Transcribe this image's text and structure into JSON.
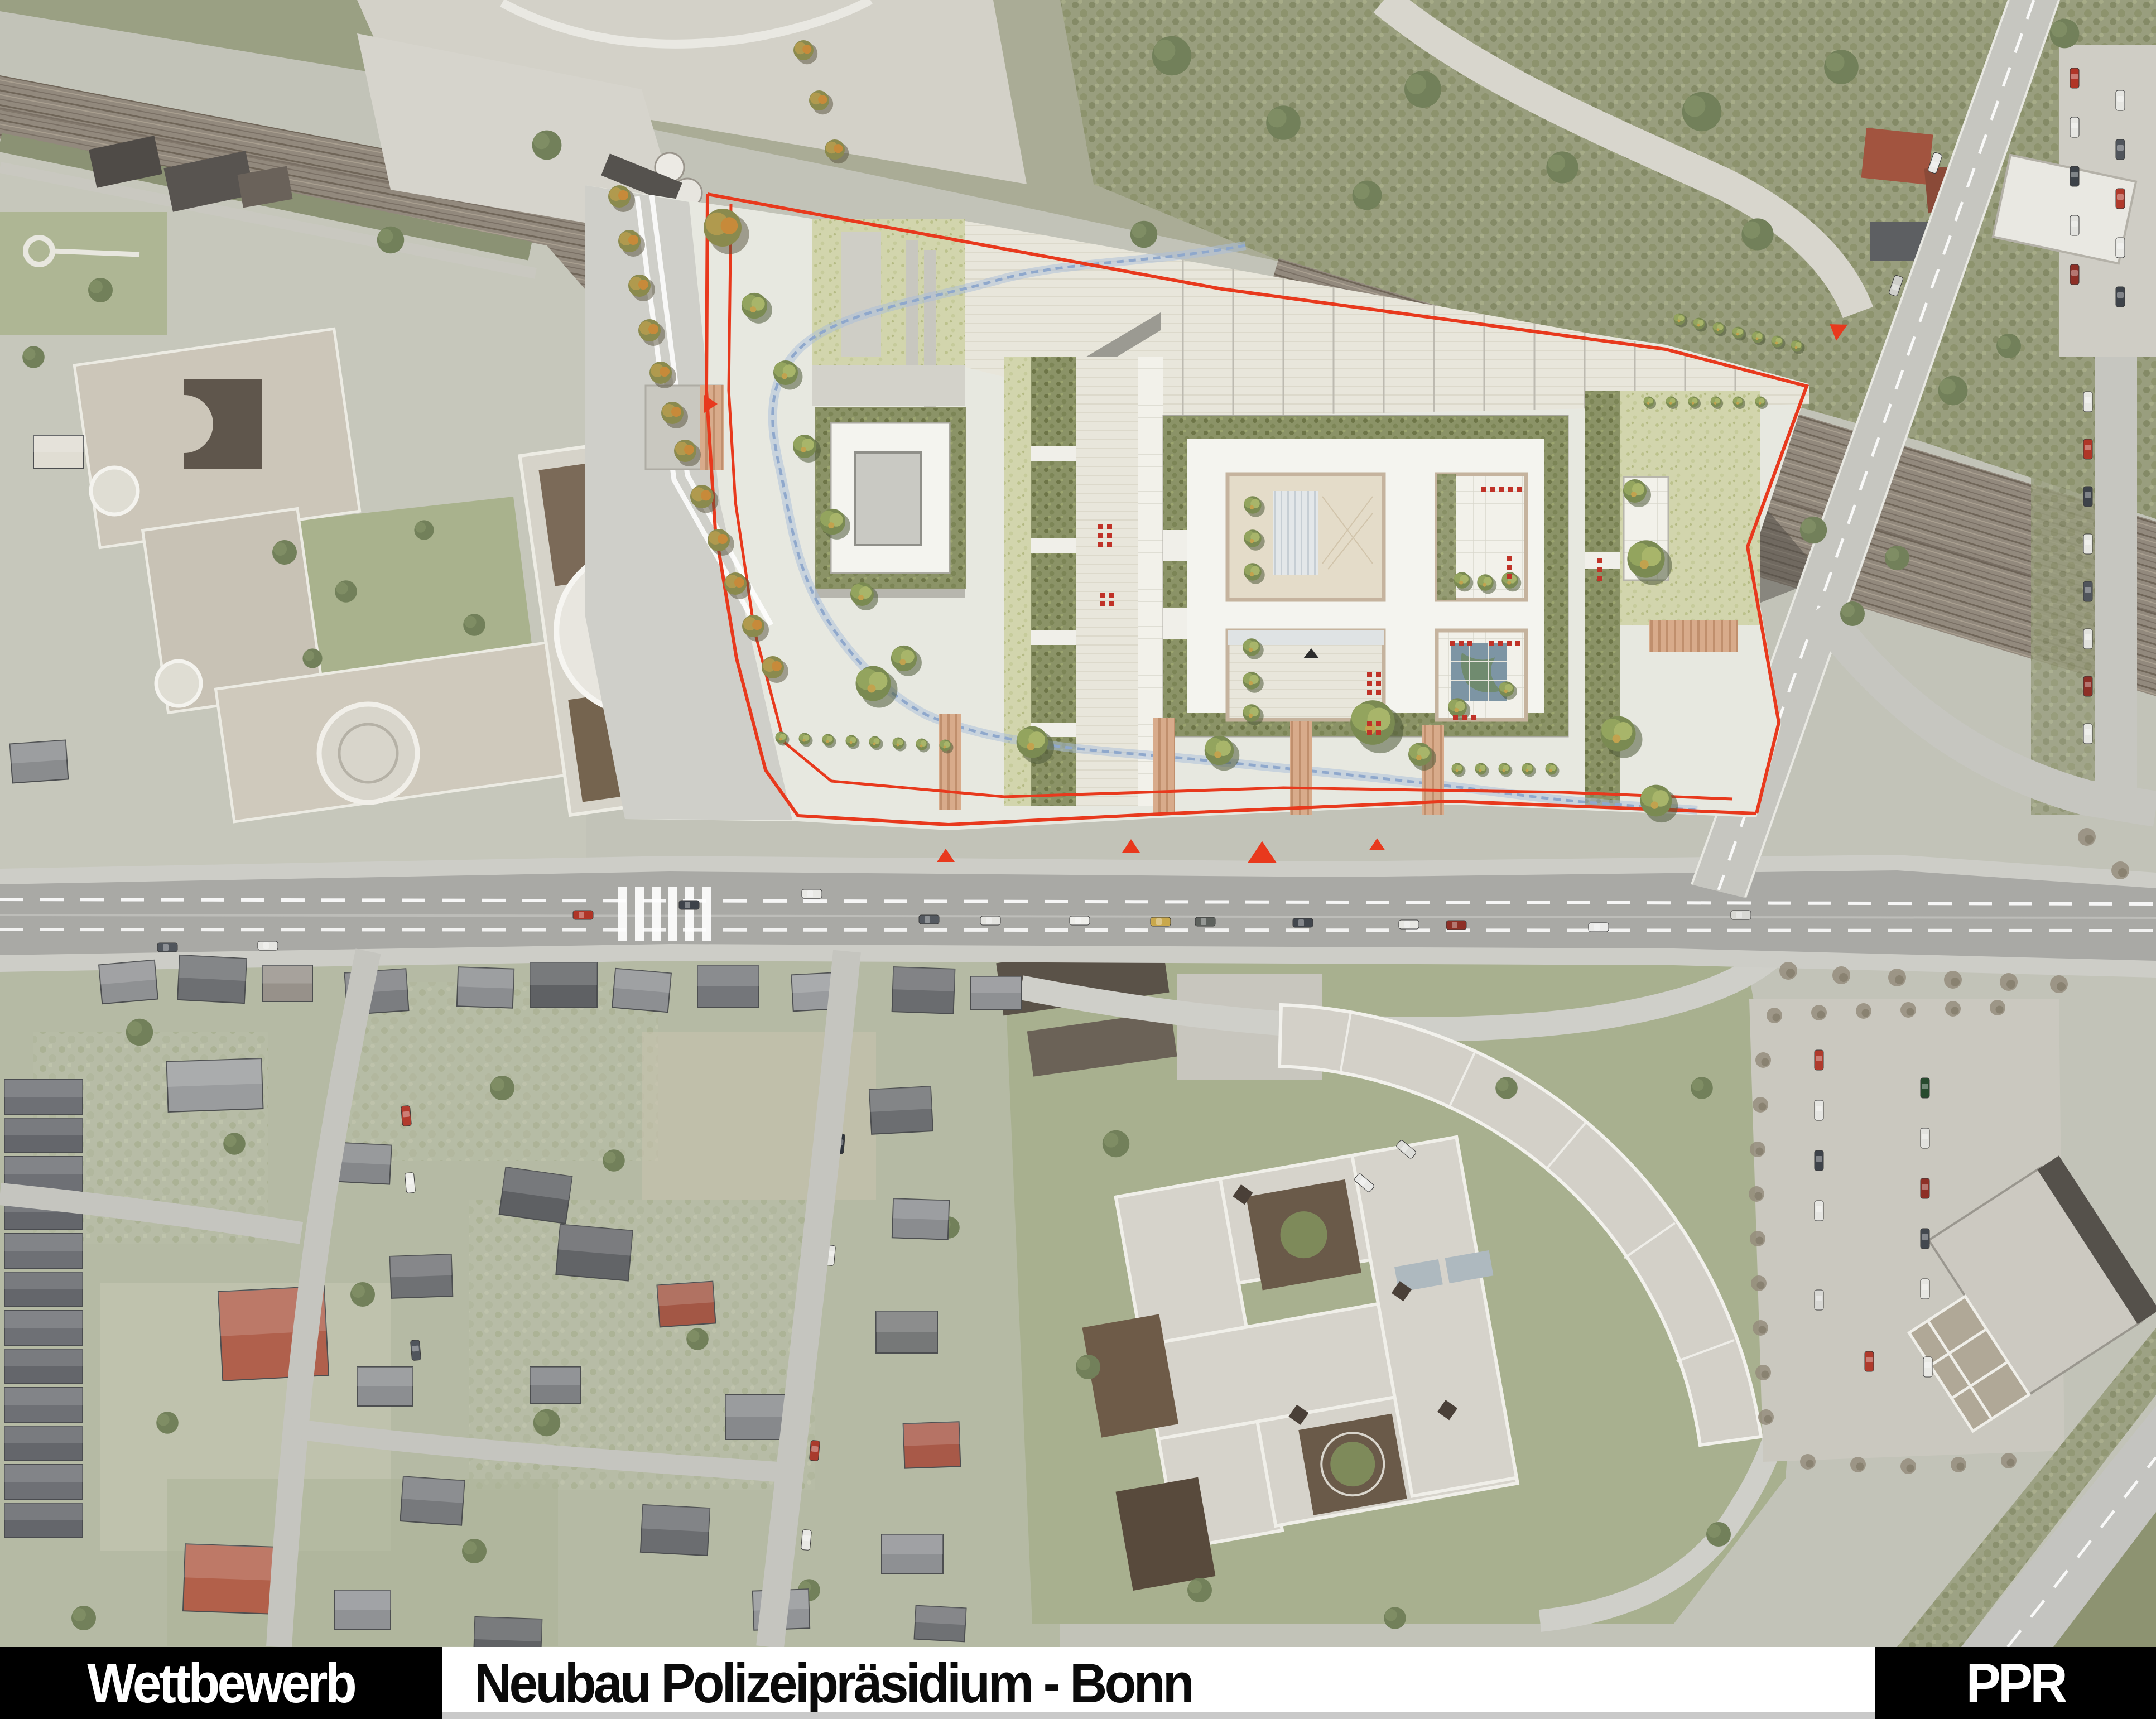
{
  "caption_bar": {
    "left_label": "Wettbewerb",
    "title": "Neubau Polizeipräsidium - Bonn",
    "right_label": "PPR"
  },
  "map": {
    "kind": "aerial-photo-with-competition-site-plan-overlay",
    "features": {
      "site_boundary": "red-plot-boundary-line",
      "entry_markers": "red-triangle-markers",
      "stream": "blue-dashed-meander-line",
      "railway": "railway-corridor-top",
      "main_road": "east-west-main-road",
      "bridge_road": "diagonal-overpass-road-right",
      "new_building": "four-courtyard-police-headquarters-plan",
      "square_building": "single-courtyard-square-building-plan",
      "existing_complex": "existing-institutional-complex-with-crescent-wing-south"
    },
    "colors": {
      "boundary_red": "#e8391d",
      "plan_paper": "#e7e8e0",
      "plan_lawn": "#d2d5ad",
      "plan_hedge": "#8b9367",
      "stream_blue": "#93a9cf",
      "pond_blue": "#7d95a4",
      "ramp_orange": "#cf9d7d",
      "asphalt": "#a9a9a5",
      "railway_brown": "#92897d",
      "roof_red": "#b0604c",
      "roof_gray": "#6d6f72"
    }
  }
}
